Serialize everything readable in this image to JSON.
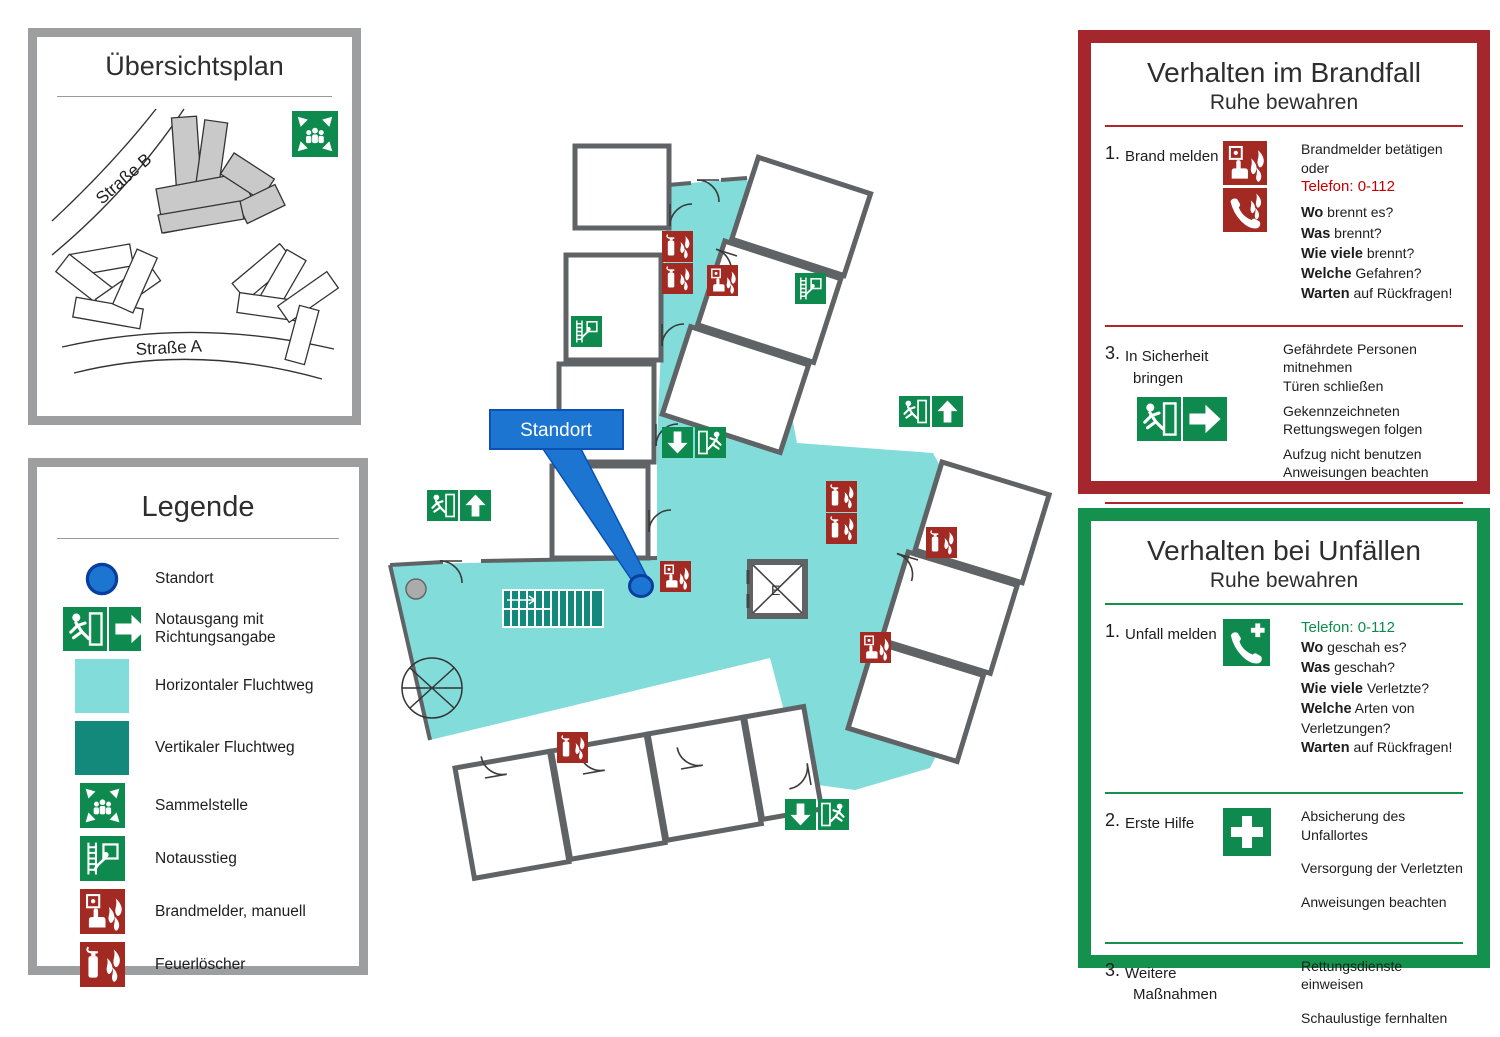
{
  "colors": {
    "escape_route_light": "#82DCDA",
    "escape_route_dark": "#13897B",
    "safety_green": "#0E8A4E",
    "safety_red": "#A22A23",
    "location_blue": "#1B75D1",
    "location_blue_border": "#0A3E9D",
    "wall_gray": "#5F6365",
    "panel_border_gray": "#9C9EA0",
    "fire_panel_border": "#A3272C",
    "accident_panel_border": "#13914D",
    "emergency_number_red": "#C00000",
    "emergency_number_green": "#0E8A4E"
  },
  "overview_panel": {
    "title": "Übersichtsplan",
    "street_b": "Straße B",
    "street_a": "Straße A",
    "icons": [
      "assembly-point-icon"
    ]
  },
  "legend_panel": {
    "title": "Legende",
    "items": [
      {
        "icon": "location-dot-icon",
        "label": "Standort"
      },
      {
        "icon": "emergency-exit-direction-icon",
        "label": "Notausgang mit Richtungsangabe"
      },
      {
        "icon": "horizontal-escape-route-swatch",
        "label": "Horizontaler Fluchtweg"
      },
      {
        "icon": "vertical-escape-route-swatch",
        "label": "Vertikaler Fluchtweg"
      },
      {
        "icon": "assembly-point-icon",
        "label": "Sammelstelle"
      },
      {
        "icon": "emergency-ladder-icon",
        "label": "Notausstieg"
      },
      {
        "icon": "manual-fire-alarm-icon",
        "label": "Brandmelder, manuell"
      },
      {
        "icon": "fire-extinguisher-icon",
        "label": "Feuerlöscher"
      }
    ]
  },
  "plan": {
    "callout_label": "Standort",
    "elevator_label": "E",
    "signs": [
      "fire-extinguisher-icon",
      "manual-fire-alarm-icon",
      "emergency-ladder-icon",
      "exit-running-man-icon",
      "arrow-up-icon",
      "arrow-down-icon",
      "location-dot-icon"
    ]
  },
  "fire_panel": {
    "title": "Verhalten im Brandfall",
    "subtitle": "Ruhe bewahren",
    "sections": [
      {
        "num": "1.",
        "label_lines": [
          "Brand melden",
          ""
        ],
        "icons": [
          "manual-fire-alarm-icon",
          "fire-emergency-phone-icon"
        ],
        "lines": [
          {
            "t": "Brandmelder betätigen oder"
          },
          {
            "t": "Telefon: 0-112"
          },
          {
            "b": "Wo",
            "t": " brennt es?"
          },
          {
            "b": "Was",
            "t": " brennt?"
          },
          {
            "b": "Wie viele",
            "t": " brennt?"
          },
          {
            "b": "Welche",
            "t": " Gefahren?"
          },
          {
            "b": "Warten",
            "t": " auf Rückfragen!"
          }
        ]
      },
      {
        "num": "3.",
        "label_lines": [
          "In Sicherheit",
          "bringen"
        ],
        "icons": [
          "emergency-exit-direction-icon"
        ],
        "lines": [
          {
            "t": "Gefährdete Personen mitnehmen"
          },
          {
            "t": "Türen schließen"
          },
          {
            "t": "Gekennzeichneten"
          },
          {
            "t": "Rettungswegen folgen"
          },
          {
            "t": "Aufzug nicht benutzen"
          },
          {
            "t": "Anweisungen beachten"
          }
        ]
      },
      {
        "num": "3.",
        "label_lines": [
          "Löschversuch",
          "unternehmen"
        ],
        "icons": [
          "fire-extinguisher-icon",
          "fire-hose-icon"
        ],
        "lines": [
          {
            "t": "Feuerlöscher,"
          },
          {
            "t": "Wandhydrant / Löschschlauch,"
          },
          {
            "t": "Mittel und Geräte zur"
          },
          {
            "t": "Brandbekämpfung"
          },
          {
            "t": "benutzen"
          }
        ]
      }
    ]
  },
  "accident_panel": {
    "title": "Verhalten bei Unfällen",
    "subtitle": "Ruhe bewahren",
    "sections": [
      {
        "num": "1.",
        "label_lines": [
          "Unfall melden",
          ""
        ],
        "icons": [
          "emergency-phone-icon"
        ],
        "lines": [
          {
            "t": "Telefon: 0-112"
          },
          {
            "b": "Wo",
            "t": " geschah es?"
          },
          {
            "b": "Was",
            "t": " geschah?"
          },
          {
            "b": "Wie viele",
            "t": " Verletzte?"
          },
          {
            "b": "Welche",
            "t": " Arten von Verletzungen?"
          },
          {
            "b": "Warten",
            "t": " auf Rückfragen!"
          }
        ]
      },
      {
        "num": "2.",
        "label_lines": [
          "Erste Hilfe",
          ""
        ],
        "icons": [
          "first-aid-cross-icon"
        ],
        "lines": [
          {
            "t": "Absicherung des Unfallortes"
          },
          {
            "t": "Versorgung der Verletzten"
          },
          {
            "t": "Anweisungen beachten"
          }
        ]
      },
      {
        "num": "3.",
        "label_lines": [
          "Weitere",
          "Maßnahmen"
        ],
        "icons": [],
        "lines": [
          {
            "t": "Rettungsdienste einweisen"
          },
          {
            "t": "Schaulustige fernhalten"
          }
        ]
      }
    ]
  }
}
